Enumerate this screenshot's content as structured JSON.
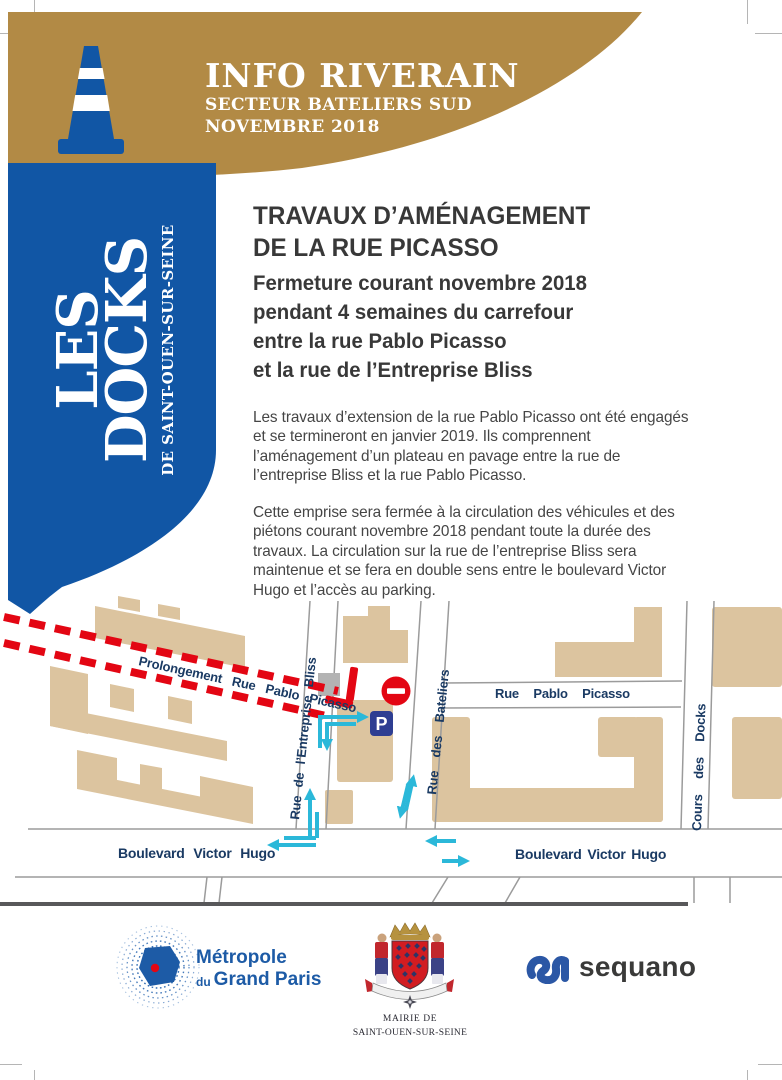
{
  "header": {
    "title": "INFO RIVERAIN",
    "sector": "SECTEUR BATELIERS SUD",
    "date": "NOVEMBRE 2018"
  },
  "sidebar": {
    "word1": "LES",
    "word2": "DOCKS",
    "subtitle": "DE SAINT-OUEN-SUR-SEINE"
  },
  "article": {
    "title_line1": "TRAVAUX D’AMÉNAGEMENT",
    "title_line2": "DE LA RUE PICASSO",
    "lead_line1": "Fermeture courant novembre 2018",
    "lead_line2": "pendant 4 semaines du carrefour",
    "lead_line3": "entre la rue Pablo Picasso",
    "lead_line4": "et la rue de l’Entreprise Bliss",
    "paragraph1": "Les travaux d’extension de la rue Pablo Picasso ont été engagés et se termineront en janvier 2019. Ils comprennent l’aménagement d’un plateau en pavage entre la rue de l’entreprise Bliss et la rue Pablo Picasso.",
    "paragraph2": "Cette emprise sera fermée à la circulation des véhicules et des piétons courant novembre 2018 pendant toute la durée des travaux. La circulation sur la rue de l’entreprise Bliss sera maintenue et se fera en double sens entre le boulevard Victor Hugo et l’accès au parking."
  },
  "map": {
    "street_labels": {
      "prolongement": "Prolongement Rue Pablo Picasso",
      "rue_pablo_picasso": "Rue Pablo Picasso",
      "rue_des_bateliers": "Rue des Bateliers",
      "rue_entreprise_bliss": "Rue de l’Entreprise Bliss",
      "cours_des_docks": "Cours des Docks",
      "boulevard_left": "Boulevard Victor Hugo",
      "boulevard_right": "Boulevard Victor Hugo"
    },
    "parking_sign": "P"
  },
  "footer": {
    "metropole": {
      "line1": "Métropole",
      "du": "du",
      "line2": "Grand Paris"
    },
    "mairie": {
      "line1": "MAIRIE DE",
      "line2": "SAINT-OUEN-SUR-SEINE"
    },
    "sequano": "sequano"
  },
  "colors": {
    "gold": "#b28a45",
    "blue": "#1156a5",
    "red": "#e30613",
    "cyan": "#2bb8d9",
    "tan": "#dcc49f",
    "navy_label": "#1a3a63",
    "parking_blue": "#2e3e92"
  }
}
